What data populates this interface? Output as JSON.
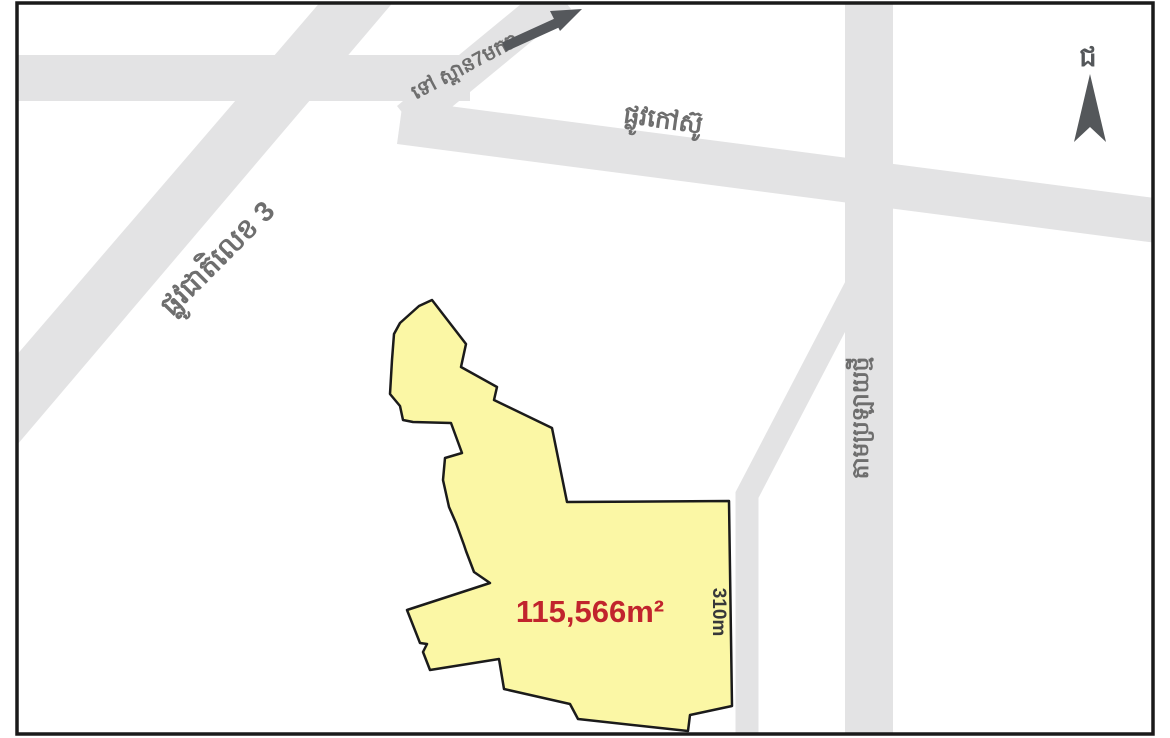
{
  "map": {
    "type": "land-parcel location sketch map",
    "parcel": {
      "area_label": "115,566m²",
      "edge_length_label": "310m"
    },
    "roads": {
      "national_road_3_label": "ផ្លូវជាតិលេខ 3",
      "paved_road_label": "ផ្លូវកៅស៊ូ",
      "to_bridge_label": "ទៅ ស្ពាន7មករា",
      "canal_road_label": "តាមប្រឡាយថ្មី"
    },
    "compass": {
      "north_letter": "ជ"
    },
    "colors": {
      "road_fill": "#e3e3e4",
      "parcel_fill": "#fbf7a5",
      "parcel_outline": "#1b1b1b",
      "area_text": "#c1242d",
      "edge_text": "#37383a",
      "road_label_text": "#6e6e6e",
      "arrow_dark": "#55585c",
      "frame": "#1a1a1a",
      "background": "#ffffff"
    }
  }
}
